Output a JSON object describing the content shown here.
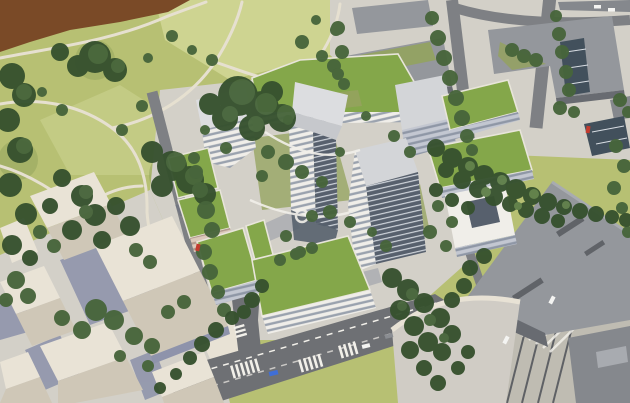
{
  "meta": {
    "type": "architectural-aerial-rendering",
    "description": "Sunlit aerial rendering of a new residential quarter: white faceted apartment towers with vivid green roofs arranged around tree-filled courtyards, bordered by a riverside park with winding paths on the upper left, existing flat-roofed gray city blocks on the upper right, a low-rise cream neighborhood on the lower left, and a wide paved boulevard with tram tracks running diagonally through the lower right."
  },
  "scene": {
    "regions": [
      "river water at top-left corner",
      "riverside park with lawns, tree canopies and light footpaths",
      "new development: white residential buildings with green roofs",
      "central faceted white tower",
      "existing gray context blocks with courtyards",
      "low-rise cream buildings with pitched roofs",
      "street intersection with zebra crosswalks",
      "boulevard with tram tracks and crossing"
    ]
  },
  "palette": {
    "grass": "#b7c073",
    "grassLight": "#ced491",
    "grassShadow": "#93a35c",
    "tree": "#47653b",
    "treeLight": "#60804a",
    "treeDark": "#36512e",
    "water": "#7a4a27",
    "path": "#e6e0d0",
    "pavement": "#d3d0c8",
    "pavementBright": "#e8e2d5",
    "groundShadow": "#8289a6",
    "asphalt": "#7e8084",
    "asphaltDark": "#6e7074",
    "lane": "#f2f0ea",
    "boulevard": "#bfbcb2",
    "tram": "#5f6165",
    "grayRoof": "#94979c",
    "grayRoofDark": "#85888d",
    "grayWall": "#686b71",
    "grayLit": "#a8abb0",
    "facade": "#f0eee9",
    "facadeRow": "#9aa2ae",
    "facadeShade": "#c3c7d1",
    "facadeShadeRow": "#8f97a6",
    "darkGlass": "#57606d",
    "ribLight": "#d8dde3",
    "greenRoof": "#84a74a",
    "greenRoofDark": "#6d9140",
    "parapet": "#e8e5da",
    "cream": "#e9e3d6",
    "creamShade": "#cfc7b7",
    "creamWall": "#8e93ab",
    "creamFacade": "#dcc9bb",
    "creamFacadeRow": "#b29a8d",
    "shadow": "#3c4a74",
    "glassCanopy": "#42505c",
    "roofLight": "#dcdde0",
    "roofMid": "#c6c8cc",
    "roofDim": "#d3d5d8",
    "curvedRoof": "#d0ccc5",
    "carBlue": "#3f6ed6",
    "carWhite": "#f4f4f2",
    "carRed": "#c33b2e",
    "carGray": "#8a8d92"
  }
}
